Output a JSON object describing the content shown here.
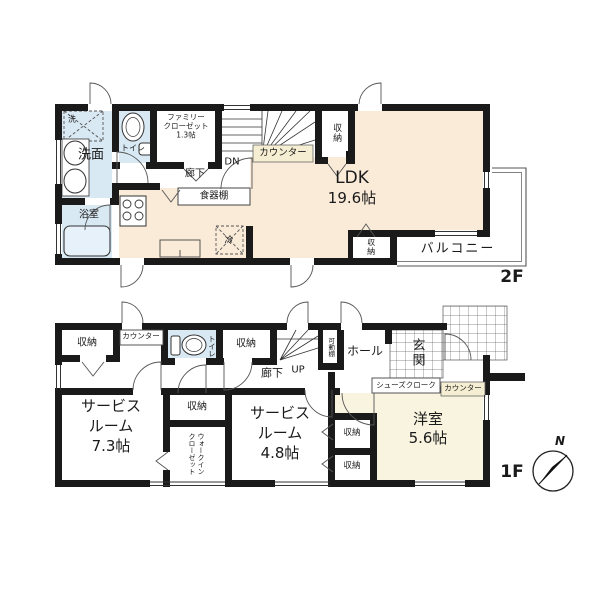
{
  "floor2": {
    "floor_label": "2F",
    "washer": "洗",
    "washroom": "洗面",
    "toilet": "トイレ",
    "family_closet": [
      "ファミリー",
      "クローゼット",
      "1.3帖"
    ],
    "hallway": "廊下",
    "stairs": "DN",
    "counter": "カウンター",
    "storage_top": "収納",
    "ldk": [
      "LDK",
      "19.6帖"
    ],
    "cupboard": "食器棚",
    "bathroom": "浴室",
    "fridge": "冷",
    "storage_bottom": "収納",
    "balcony": "バルコニー"
  },
  "floor1": {
    "floor_label": "1F",
    "storage_nw": "収納",
    "counter_left": "カウンター",
    "toilet": "トイレ",
    "storage_top": "収納",
    "stairs": "UP",
    "movable_shelf": "可動棚",
    "hall": "ホール",
    "entrance": "玄関",
    "shoe_cloak": "シューズクローク",
    "counter_right": "カウンター",
    "hallway": "廊下",
    "service_room_a": [
      "サービス",
      "ルーム",
      "7.3帖"
    ],
    "storage_mid": "収納",
    "walk_in_closet": [
      "ウォークイン",
      "クローゼット"
    ],
    "service_room_b": [
      "サービス",
      "ルーム",
      "4.8帖"
    ],
    "storage_r1": "収納",
    "storage_r2": "収納",
    "western_room": [
      "洋室",
      "5.6帖"
    ],
    "compass_north": "N"
  },
  "colors": {
    "wall": "#1a1a1a",
    "ldk-fill": "#faebd9",
    "western-fill": "#f9f4e0",
    "water-fill": "#d9e9f4",
    "counter-fill": "#f6eed2"
  }
}
